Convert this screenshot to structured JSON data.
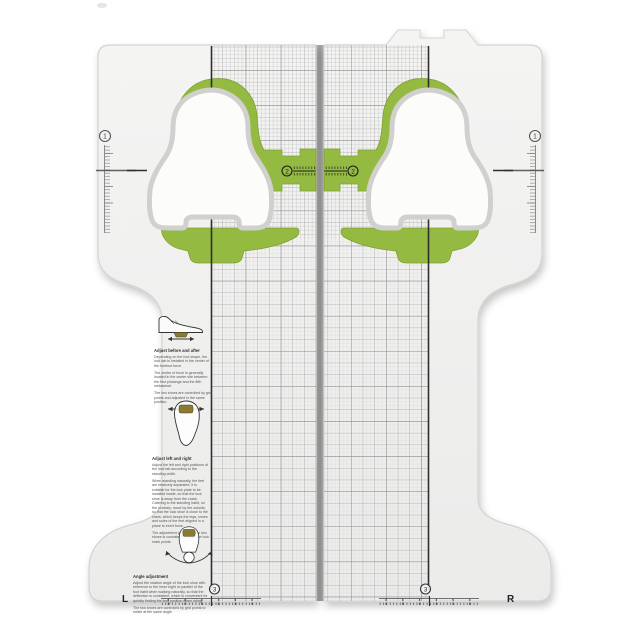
{
  "product_label": {
    "left": "L",
    "right": "R"
  },
  "markers": {
    "m1": "1",
    "m2": "2",
    "m3": "3"
  },
  "instructions": [
    {
      "caption": "Adjust before and after",
      "paragraphs": [
        "Depending on the foot shape, the lock tab is installed in the center of the forefoot force.",
        "The center of force is generally located in the center site between the first phalange and the fifth metatarsal.",
        "The two shoes are controlled by grid points and adjusted in the same position."
      ]
    },
    {
      "caption": "Adjust left and right",
      "paragraphs": [
        "Adjust the left and right positions of the lock tab according to the standing width.",
        "When standing naturally, the feet are relatively separated. It is suitable for the lock plate to be installed inside, so that the lock shoe is away from the crank. Catering to the standing habit, on the contrary, move by the outside, so that the lock shoe is close to the crank, which keeps the legs, knees and soles of the feet aligned in a plane to exert force.",
        "The adjustment position of the two shoes is consistent through the lock mark points."
      ]
    },
    {
      "caption": "Angle adjustment",
      "paragraphs": [
        "Adjust the rotation angle of the lock shoe with reference to the inner eight or parallel of the foot habit when walking naturally, so that the deflection is consistent, which is convenient for quickly finding the lock position when riding.",
        "The two shoes are controlled by grid points to rotate at the same angle."
      ]
    }
  ],
  "colors": {
    "green": "#95ba42",
    "olive": "#8a7b33",
    "board": "#f2f2f1",
    "ink": "#2e2e2e"
  }
}
